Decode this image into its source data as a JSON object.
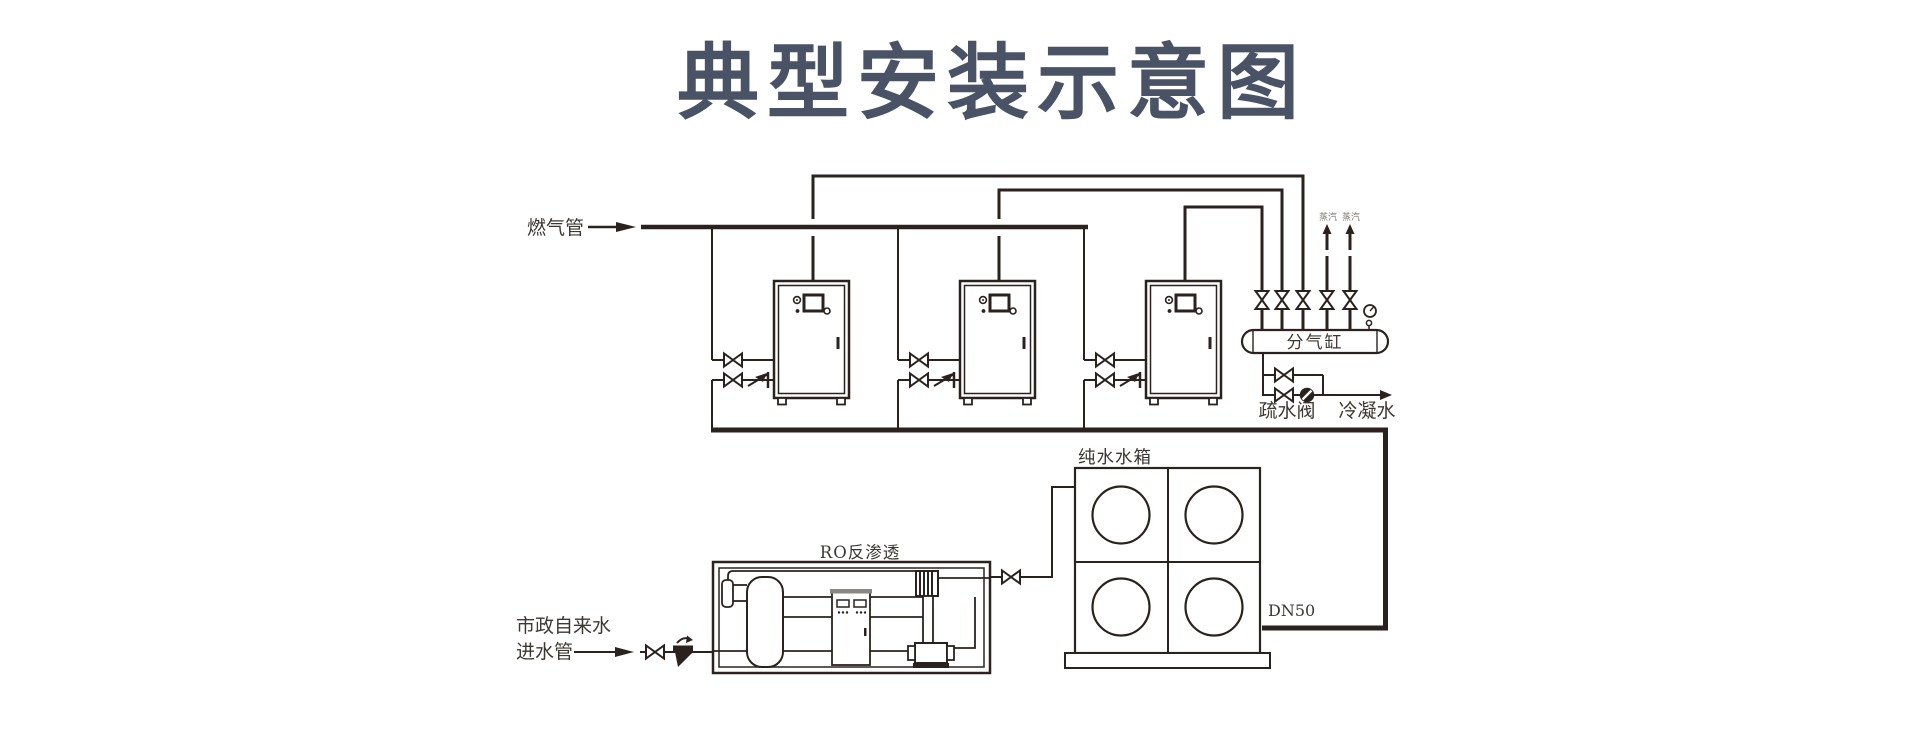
{
  "title": "典型安装示意图",
  "colors": {
    "line": "#2b2220",
    "title": "#4a5366",
    "label": "#3c3733",
    "small_label": "#807b78"
  },
  "labels": {
    "gas_pipe": "燃气管",
    "steam_outlet_1": "蒸汽",
    "steam_outlet_2": "蒸汽",
    "manifold": "分气缸",
    "trap_valve": "疏水阀",
    "condensate": "冷凝水",
    "pure_water_tank": "纯水水箱",
    "pipe_size": "DN50",
    "ro_unit": "RO反渗透",
    "municipal_line1": "市政自来水",
    "municipal_line2": "进水管"
  }
}
